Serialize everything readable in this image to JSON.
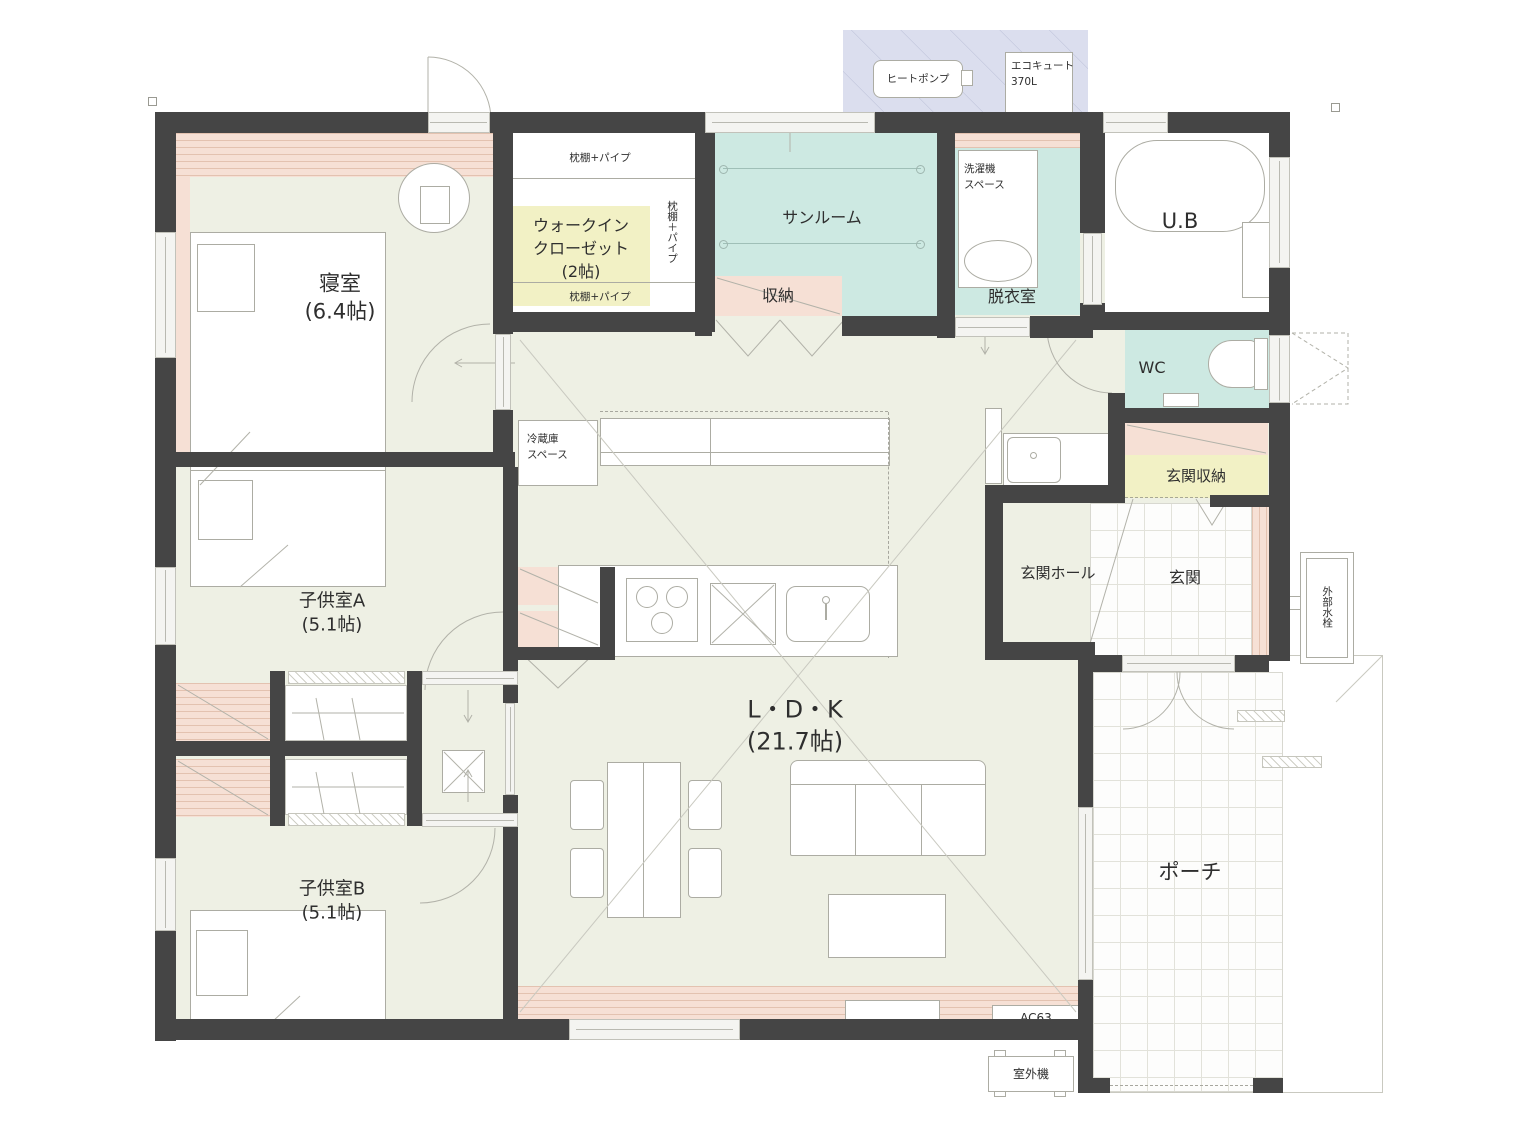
{
  "colors": {
    "wall": "#454545",
    "floor": "#eef0e4",
    "pink": "#f6e0d5",
    "teal": "#cde9e2",
    "yellow": "#f2f1c5",
    "lavender": "#dbdeee",
    "line": "#acaca3",
    "white": "#ffffff"
  },
  "rooms": {
    "bedroom": {
      "name": "寝室",
      "size": "(6.4帖)"
    },
    "wic": {
      "line1": "ウォークイン",
      "line2": "クローゼット",
      "size": "(2帖)"
    },
    "sunroom": {
      "name": "サンルーム"
    },
    "storage": {
      "name": "収納"
    },
    "laundry": {
      "line1": "洗濯機",
      "line2": "スペース"
    },
    "dressing": {
      "name": "脱衣室"
    },
    "bath": {
      "name": "U.B"
    },
    "wc": {
      "name": "WC"
    },
    "entrance_storage": {
      "name": "玄関収納"
    },
    "entrance_hall": {
      "name": "玄関ホール"
    },
    "entrance": {
      "name": "玄関"
    },
    "kids_a": {
      "name": "子供室A",
      "size": "(5.1帖)"
    },
    "kids_b": {
      "name": "子供室B",
      "size": "(5.1帖)"
    },
    "ldk": {
      "name": "L・D・K",
      "size": "(21.7帖)"
    },
    "porch": {
      "name": "ポーチ"
    }
  },
  "closet": {
    "shelf_top": "枕棚+パイプ",
    "shelf_bottom": "枕棚+パイプ",
    "shelf_side": "枕棚＋パイプ"
  },
  "equipment": {
    "heat_pump": "ヒートポンプ",
    "ecocute_line1": "エコキュート",
    "ecocute_line2": "370L",
    "fridge_line1": "冷蔵庫",
    "fridge_line2": "スペース",
    "outdoor_faucet": "外部水栓",
    "outdoor_unit": "室外機",
    "ac_label": "AC63"
  }
}
